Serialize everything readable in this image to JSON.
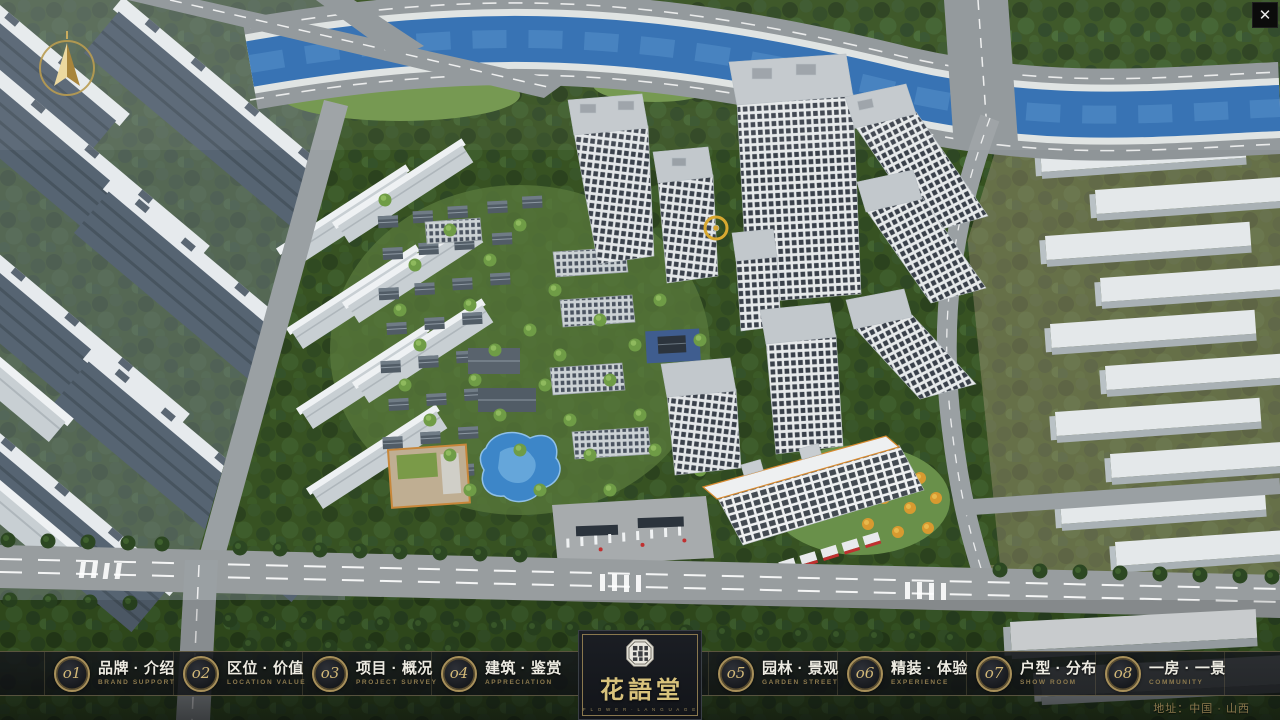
{
  "window": {
    "close_glyph": "✕"
  },
  "nav": {
    "items": [
      {
        "num": "o1",
        "title": "品牌 · 介绍",
        "subtitle": "BRAND SUPPORT"
      },
      {
        "num": "o2",
        "title": "区位 · 价值",
        "subtitle": "LOCATION VALUE"
      },
      {
        "num": "o3",
        "title": "项目 · 概况",
        "subtitle": "PROJECT SURVEY"
      },
      {
        "num": "o4",
        "title": "建筑 · 鉴赏",
        "subtitle": "APPRECIATION"
      },
      {
        "num": "o5",
        "title": "园林 · 景观",
        "subtitle": "GARDEN STREET"
      },
      {
        "num": "o6",
        "title": "精装 · 体验",
        "subtitle": "EXPERIENCE"
      },
      {
        "num": "o7",
        "title": "户型 · 分布",
        "subtitle": "SHOW ROOM"
      },
      {
        "num": "o8",
        "title": "一房 · 一景",
        "subtitle": "COMMUNITY"
      }
    ]
  },
  "logo": {
    "name": "花語堂",
    "subtitle": "F L O W E R · L A N G U A G E"
  },
  "footer": {
    "address": "地址：中国 · 山西"
  },
  "palette": {
    "gold": "#c6ab67",
    "gold_dim": "#8d7a4e",
    "bar_bg": "#14171b",
    "text_light": "#edebe2",
    "river_blue": "#2e6cb0",
    "forest_green": "#2e4a23",
    "road_grey": "#9aa0a3",
    "tower_window": "#39404a"
  }
}
